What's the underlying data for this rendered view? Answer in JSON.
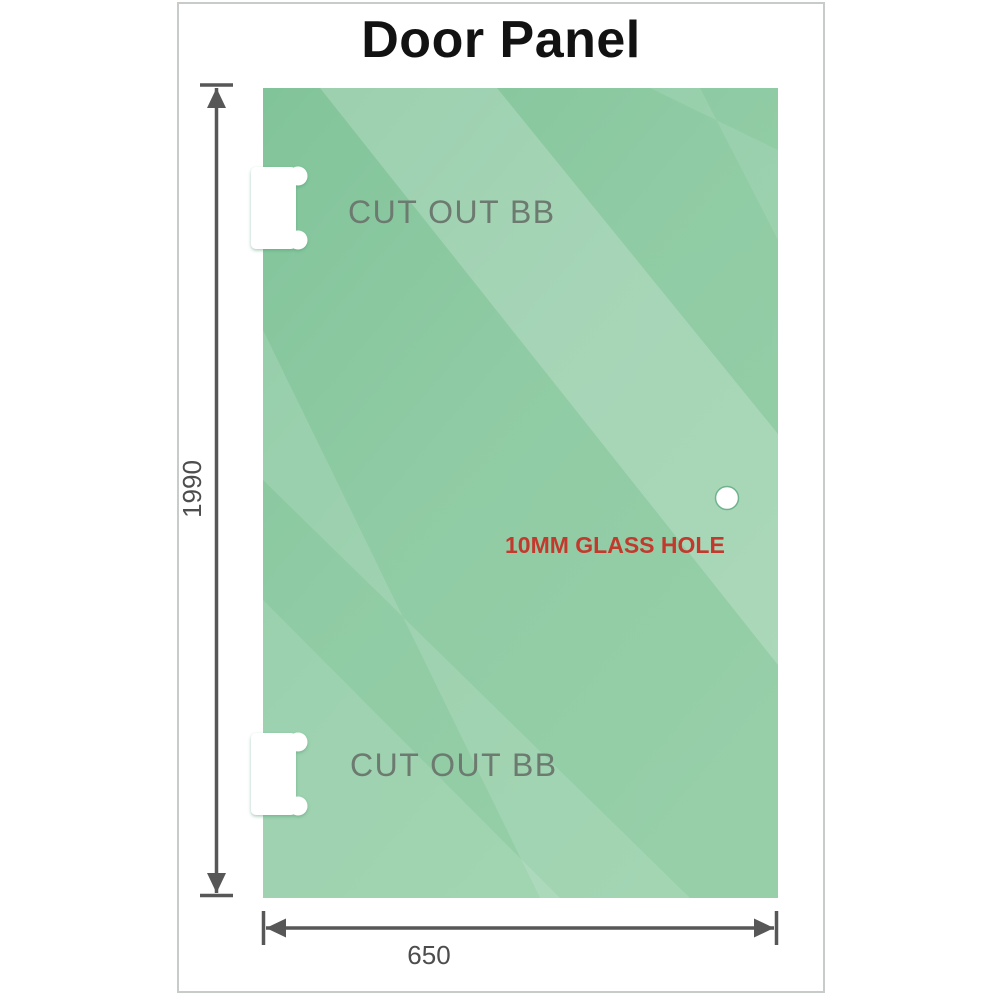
{
  "title": "Door Panel",
  "panel": {
    "description": "glass shower door panel drawing",
    "cutout_top_label": "CUT OUT BB",
    "cutout_bottom_label": "CUT OUT BB",
    "glass_hole_label": "10MM GLASS HOLE"
  },
  "dimensions": {
    "height": "1990",
    "width": "650"
  },
  "colors": {
    "glass_green_base": "#8cc9a2",
    "glass_green_dark": "#82c49a",
    "glass_green_light": "#b9e0c3",
    "dimension_line_gray": "#575757",
    "dimension_text_gray": "#4d4d4d",
    "cutout_label_gray": "#6d7a70",
    "glass_hole_label_red": "#c2392e",
    "frame_border_gray": "#c8ccc8",
    "title_black": "#121212",
    "background_white": "#ffffff"
  }
}
